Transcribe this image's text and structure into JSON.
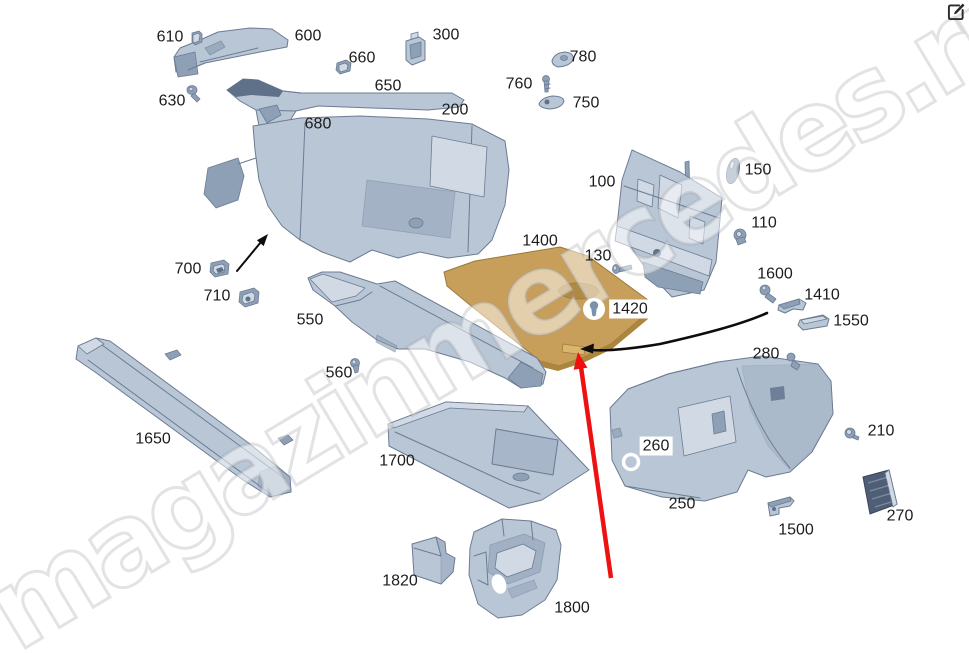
{
  "watermark": {
    "text": "magazinmercedes.ru"
  },
  "icons": {
    "top_right": "edit-icon",
    "part_1420_marker": "pin-icon",
    "part_260_marker": "hole-ring-icon"
  },
  "colors": {
    "background": "#ffffff",
    "part_fill": "#b9c6d6",
    "part_fill_light": "#d0d9e4",
    "part_fill_dark": "#8ea0b5",
    "part_deep": "#5f7189",
    "part_stroke": "#6b7c93",
    "highlight_fill": "#c89f5a",
    "highlight_dark": "#ad863e",
    "highlight_tab": "#d9b66c",
    "highlight_stroke": "#9a7a38",
    "grille_fill": "#4d5e76",
    "grille_stroke": "#36465c",
    "label_color": "#1c1c1c",
    "red_arrow": "#ee1111",
    "black_arrow": "#0d0d0d",
    "pin_icon_color": "#7c92aa"
  },
  "diagram": {
    "type": "exploded-parts-diagram",
    "highlighted_part": "1400",
    "parts": [
      {
        "number": "610",
        "x": 170,
        "y": 37
      },
      {
        "number": "600",
        "x": 308,
        "y": 36
      },
      {
        "number": "660",
        "x": 362,
        "y": 58
      },
      {
        "number": "300",
        "x": 446,
        "y": 35
      },
      {
        "number": "630",
        "x": 172,
        "y": 101
      },
      {
        "number": "650",
        "x": 388,
        "y": 86
      },
      {
        "number": "680",
        "x": 318,
        "y": 124
      },
      {
        "number": "200",
        "x": 455,
        "y": 110
      },
      {
        "number": "780",
        "x": 583,
        "y": 57
      },
      {
        "number": "760",
        "x": 519,
        "y": 84
      },
      {
        "number": "750",
        "x": 586,
        "y": 103
      },
      {
        "number": "100",
        "x": 602,
        "y": 182
      },
      {
        "number": "150",
        "x": 758,
        "y": 170
      },
      {
        "number": "110",
        "x": 764,
        "y": 223
      },
      {
        "number": "1400",
        "x": 540,
        "y": 241
      },
      {
        "number": "130",
        "x": 598,
        "y": 256
      },
      {
        "number": "1600",
        "x": 775,
        "y": 274
      },
      {
        "number": "1410",
        "x": 822,
        "y": 295
      },
      {
        "number": "1550",
        "x": 851,
        "y": 321
      },
      {
        "number": "700",
        "x": 188,
        "y": 269
      },
      {
        "number": "710",
        "x": 217,
        "y": 296
      },
      {
        "number": "550",
        "x": 310,
        "y": 320
      },
      {
        "number": "1420",
        "x": 630,
        "y": 309,
        "boxed": true
      },
      {
        "number": "560",
        "x": 339,
        "y": 373
      },
      {
        "number": "280",
        "x": 766,
        "y": 354
      },
      {
        "number": "1650",
        "x": 153,
        "y": 439
      },
      {
        "number": "1700",
        "x": 397,
        "y": 461
      },
      {
        "number": "260",
        "x": 656,
        "y": 446,
        "boxed": true
      },
      {
        "number": "210",
        "x": 881,
        "y": 431
      },
      {
        "number": "250",
        "x": 682,
        "y": 504
      },
      {
        "number": "270",
        "x": 900,
        "y": 516
      },
      {
        "number": "1500",
        "x": 796,
        "y": 530
      },
      {
        "number": "1820",
        "x": 400,
        "y": 581
      },
      {
        "number": "1800",
        "x": 572,
        "y": 608
      }
    ]
  }
}
